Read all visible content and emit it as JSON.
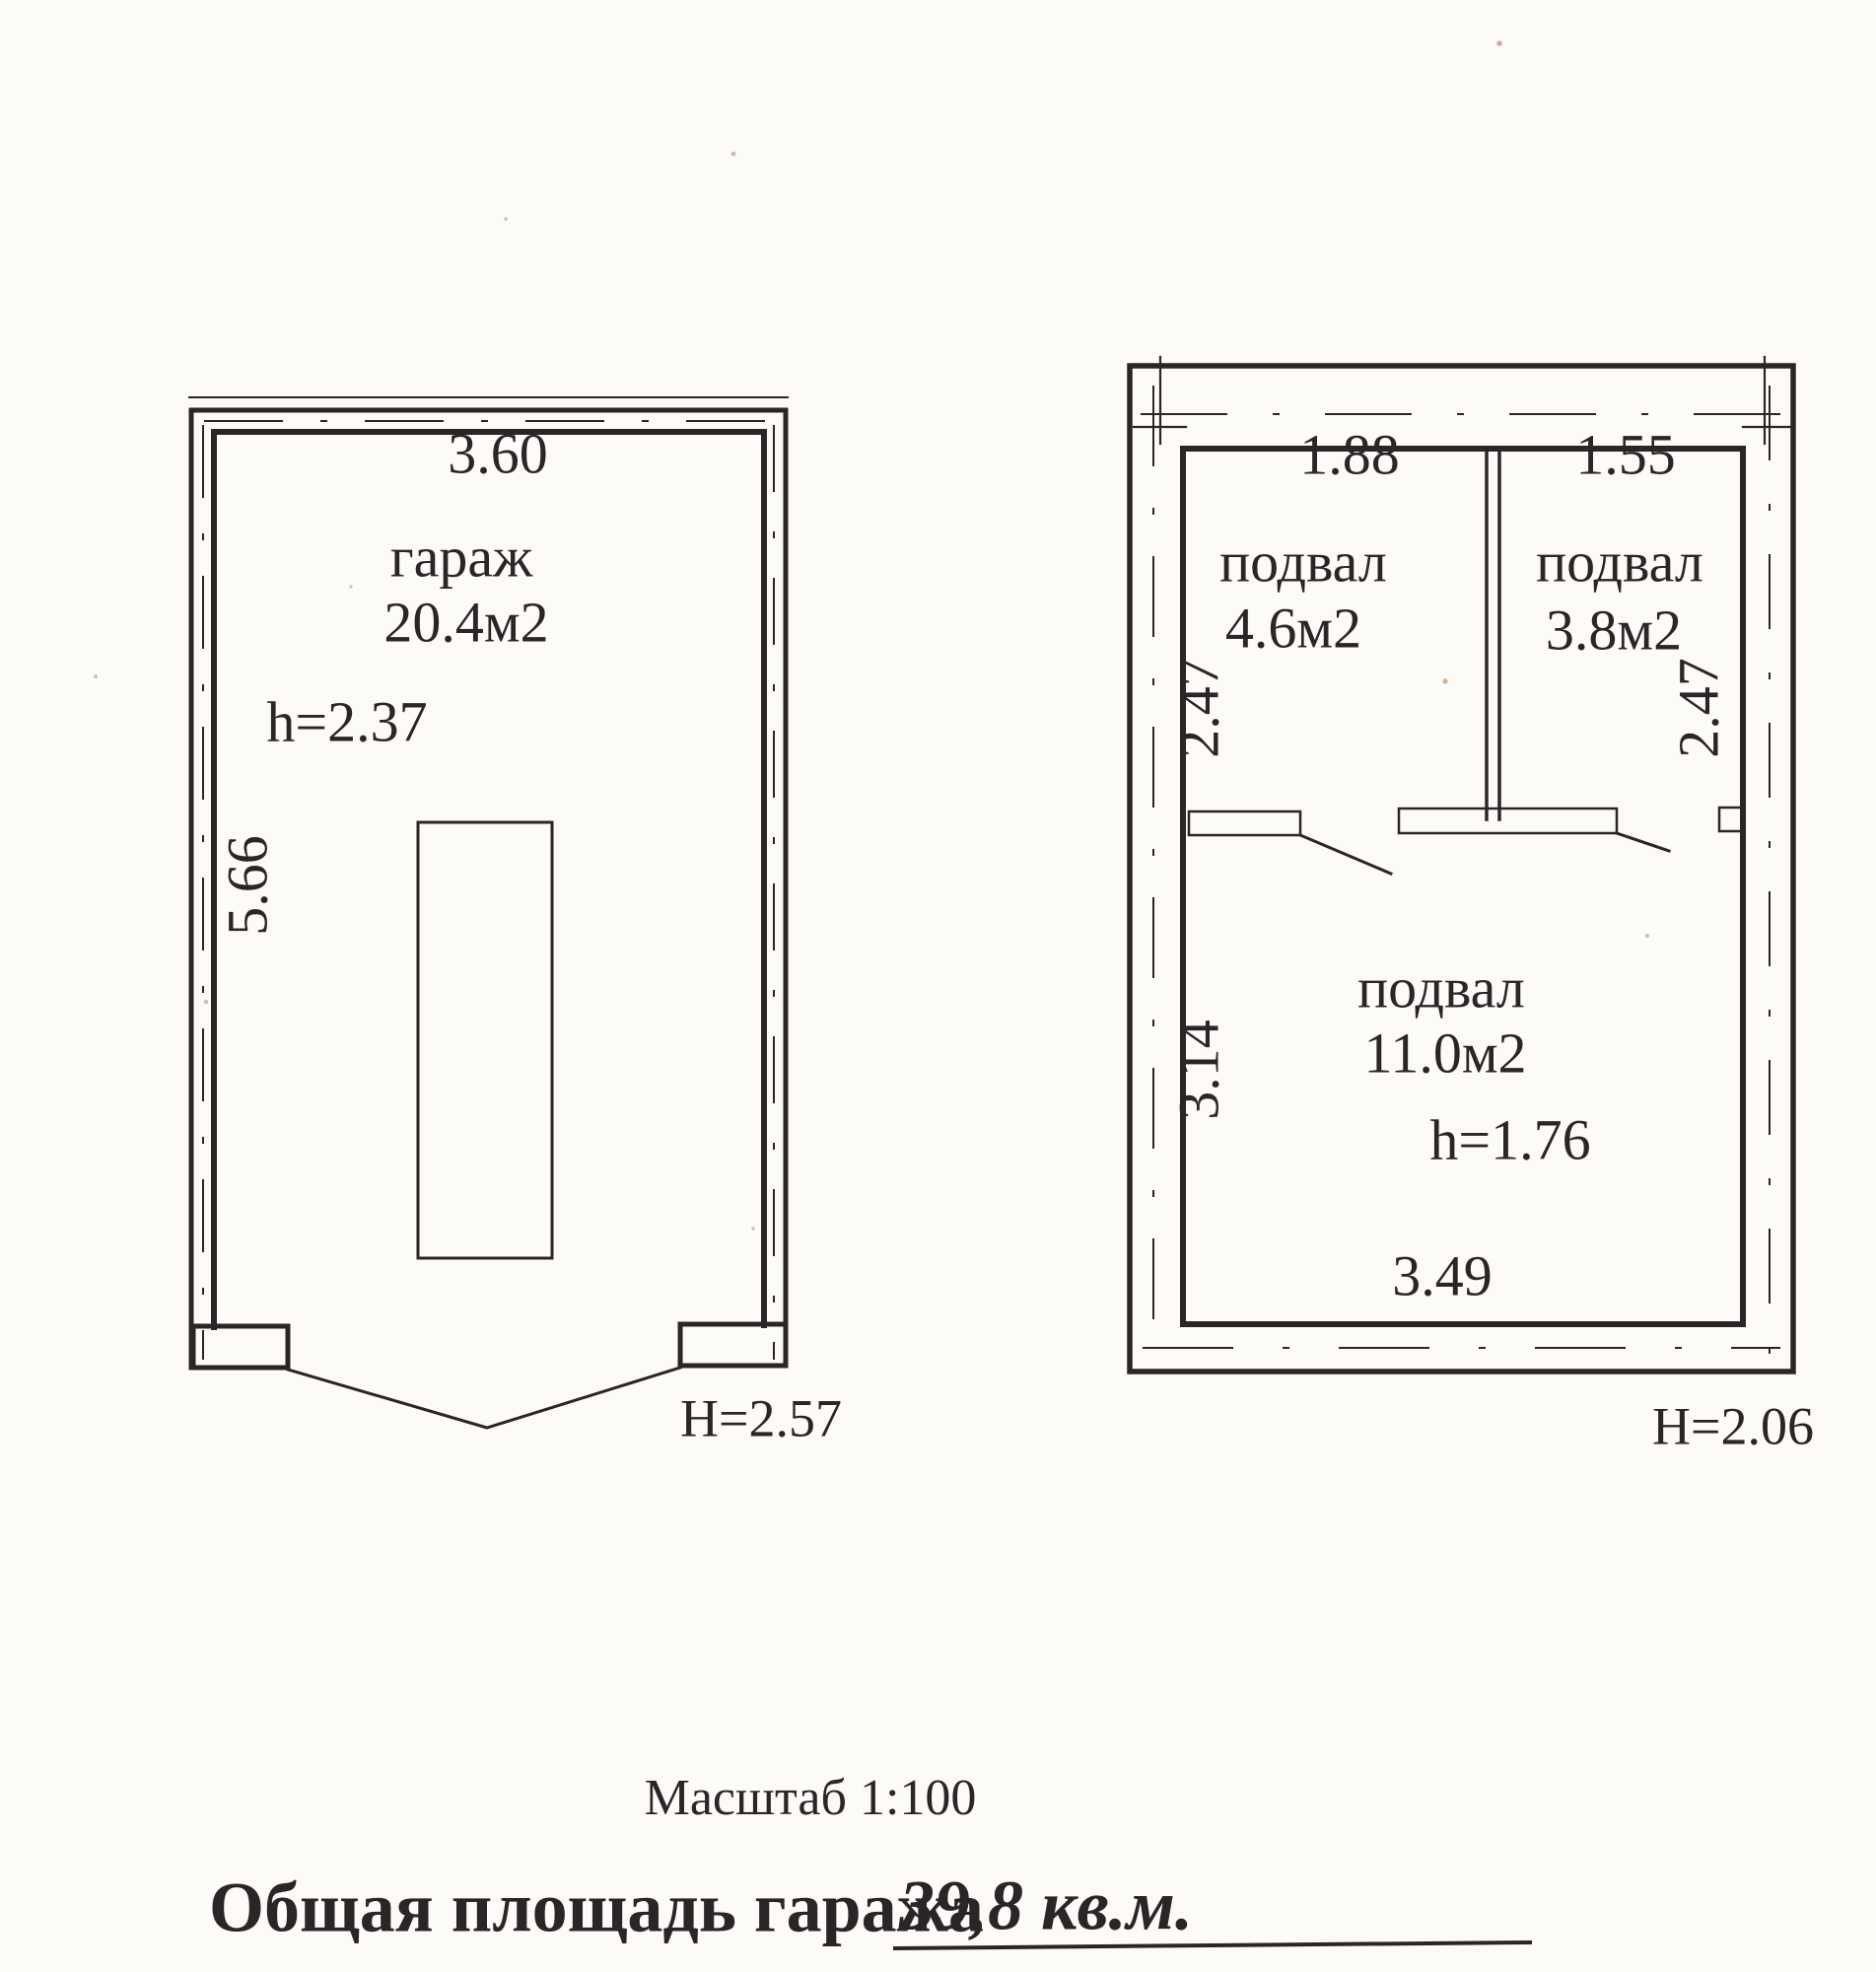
{
  "colors": {
    "ink": "#2b2528",
    "paper": "#fcfbf8"
  },
  "garage_plan": {
    "width_dim": "3.60",
    "room_label": "гараж",
    "room_area": "20.4м2",
    "ceiling_height": "h=2.37",
    "depth_dim": "5.66",
    "exterior_height": "H=2.57"
  },
  "basement_plan": {
    "rooms": [
      {
        "label": "подвал",
        "area": "4.6м2",
        "width_dim": "1.88",
        "depth_dim": "2.47"
      },
      {
        "label": "подвал",
        "area": "3.8м2",
        "width_dim": "1.55",
        "depth_dim": "2.47"
      },
      {
        "label": "подвал",
        "area": "11.0м2",
        "ceiling_height": "h=1.76",
        "width_dim": "3.49",
        "depth_dim": "3.14"
      }
    ],
    "exterior_height": "H=2.06"
  },
  "footer": {
    "scale_label": "Масштаб 1:100",
    "total_area_label": "Общая площадь гаража",
    "total_area_value": "39,8 кв.м."
  }
}
